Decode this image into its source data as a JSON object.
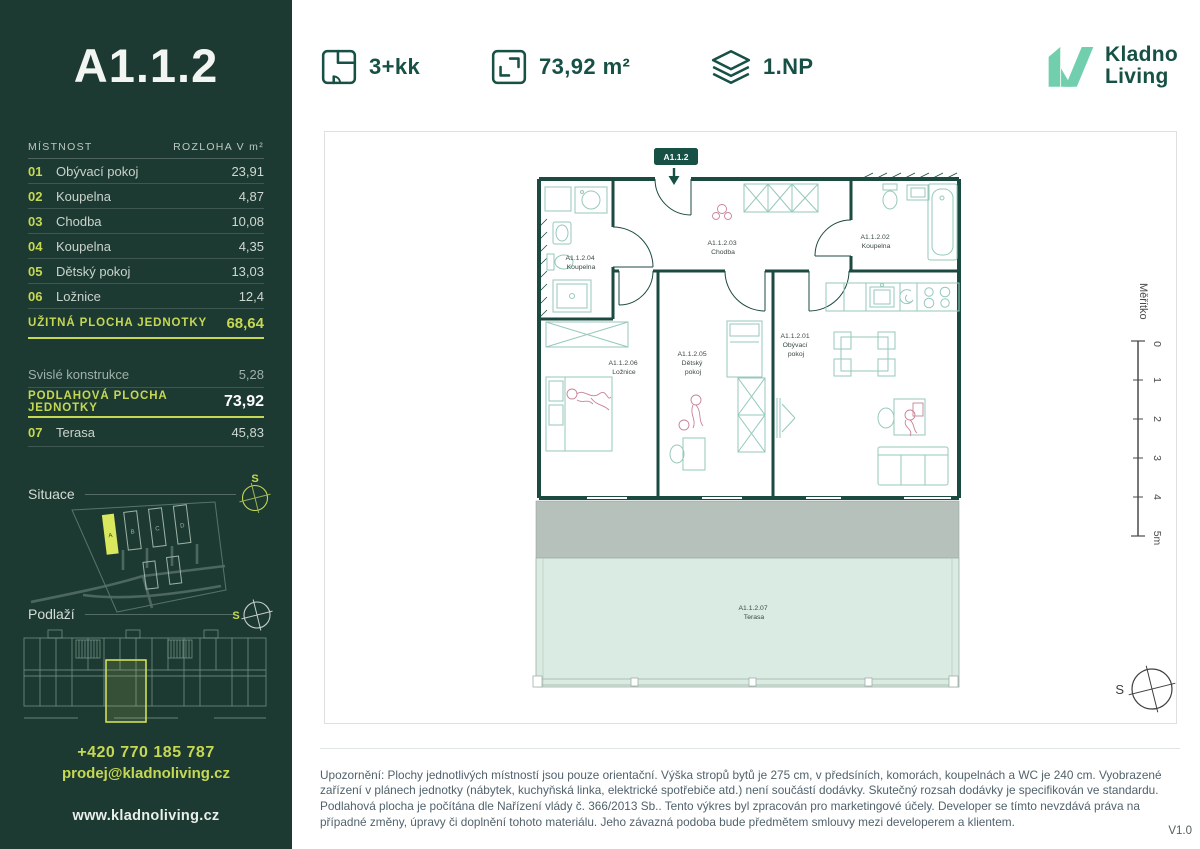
{
  "sidebar": {
    "unit_title": "A1.1.2",
    "table": {
      "col_room": "MÍSTNOST",
      "col_area": "ROZLOHA V m²",
      "rows": [
        {
          "num": "01",
          "name": "Obývací pokoj",
          "area": "23,91"
        },
        {
          "num": "02",
          "name": "Koupelna",
          "area": "4,87"
        },
        {
          "num": "03",
          "name": "Chodba",
          "area": "10,08"
        },
        {
          "num": "04",
          "name": "Koupelna",
          "area": "4,35"
        },
        {
          "num": "05",
          "name": "Dětský pokoj",
          "area": "13,03"
        },
        {
          "num": "06",
          "name": "Ložnice",
          "area": "12,4"
        }
      ],
      "usable": {
        "label": "UŽITNÁ PLOCHA JEDNOTKY",
        "value": "68,64"
      },
      "construction": {
        "label": "Svislé konstrukce",
        "value": "5,28"
      },
      "floor_area": {
        "label": "PODLAHOVÁ PLOCHA JEDNOTKY",
        "value": "73,92"
      },
      "terrace": {
        "num": "07",
        "name": "Terasa",
        "area": "45,83"
      }
    },
    "situace_label": "Situace",
    "podlazi_label": "Podlaží",
    "compass_letter": "S",
    "site_buildings": [
      "A",
      "B",
      "C",
      "D"
    ],
    "contact": {
      "phone": "+420 770 185 787",
      "email": "prodej@kladnoliving.cz",
      "web": "www.kladnoliving.cz"
    }
  },
  "header": {
    "specs": [
      {
        "icon": "floorplan-icon",
        "value": "3+kk"
      },
      {
        "icon": "area-icon",
        "value": "73,92 m²"
      },
      {
        "icon": "layers-icon",
        "value": "1.NP"
      }
    ],
    "logo": {
      "line1": "Kladno",
      "line2": "Living"
    }
  },
  "plan": {
    "badge": "A1.1.2",
    "rooms": [
      {
        "lines": [
          "A1.1.2.01",
          "Obývací",
          "pokoj"
        ]
      },
      {
        "lines": [
          "A1.1.2.02",
          "Koupelna"
        ]
      },
      {
        "lines": [
          "A1.1.2.03",
          "Chodba"
        ]
      },
      {
        "lines": [
          "A1.1.2.04",
          "Koupelna"
        ]
      },
      {
        "lines": [
          "A1.1.2.05",
          "Dětský",
          "pokoj"
        ]
      },
      {
        "lines": [
          "A1.1.2.06",
          "Ložnice"
        ]
      },
      {
        "lines": [
          "A1.1.2.07",
          "Terasa"
        ]
      }
    ],
    "scale": {
      "label": "Měřítko",
      "ticks": [
        "0",
        "1",
        "2",
        "3",
        "4",
        "5m"
      ]
    },
    "compass_letter": "S"
  },
  "footer": {
    "disclaimer": "Upozornění: Plochy jednotlivých místností jsou pouze orientační. Výška stropů bytů je 275 cm, v předsíních, komorách, koupelnách a WC je 240 cm. Vyobrazené zařízení v plánech jednotky (nábytek, kuchyňská linka, elektrické spotřebiče atd.) není součástí dodávky. Skutečný rozsah dodávky je specifikován ve standardu. Podlahová plocha je počítána dle Nařízení vlády č. 366/2013 Sb.. Tento výkres byl zpracován pro marketingové účely. Developer se tímto nevzdává práva na případné změny, úpravy či doplnění tohoto materiálu. Jeho závazná podoba bude předmětem smlouvy mezi developerem a klientem.",
    "version": "V1.0"
  },
  "colors": {
    "sidebar_bg": "#1d3a32",
    "accent": "#c6d852",
    "brand_green": "#175044",
    "logo_mint": "#72cfae",
    "wall": "#1b4a40",
    "furniture": "#96c9bb",
    "terrace_fill": "#d9ebe2",
    "terrace_wall": "#b7c1bb",
    "figure_pink": "#c98295"
  }
}
